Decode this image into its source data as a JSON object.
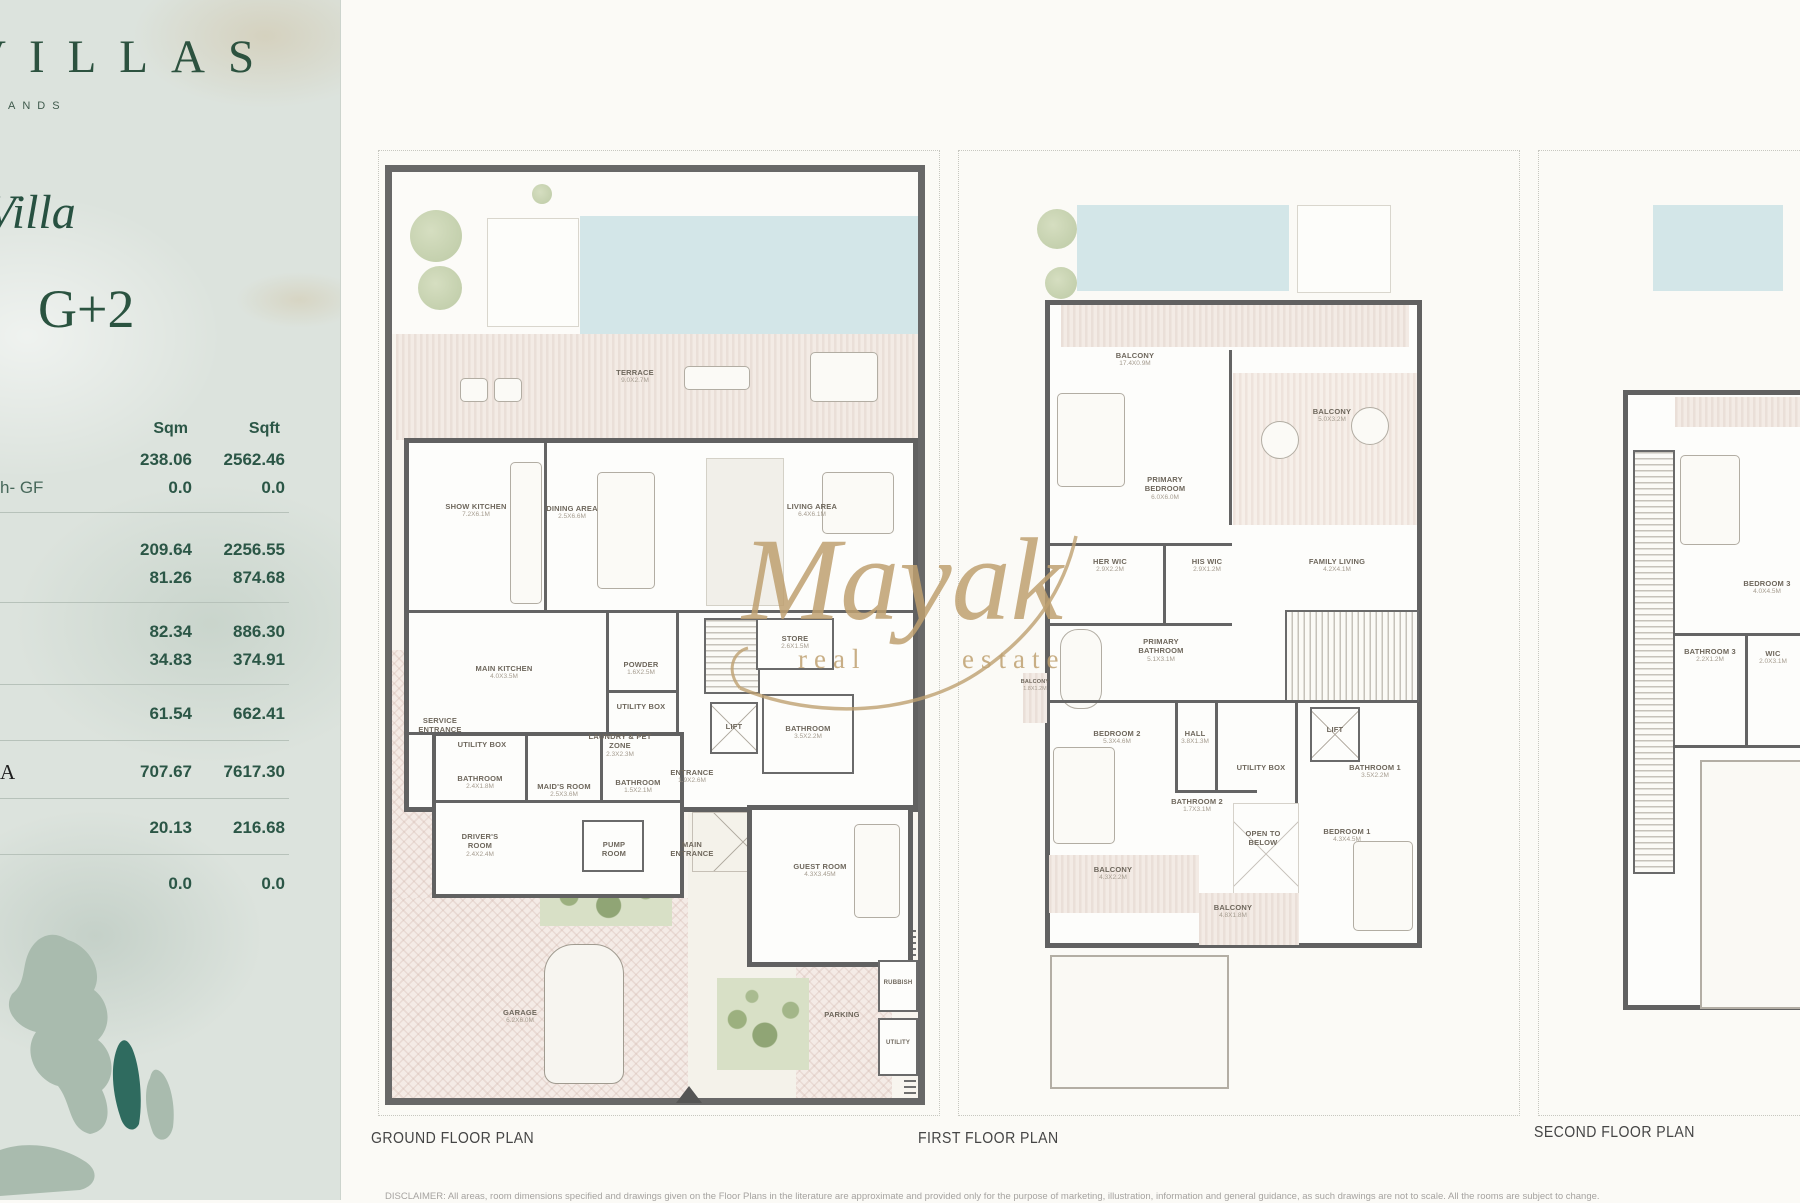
{
  "sidebar": {
    "logo_text": "VILLAS",
    "logo_sub": "ANDS",
    "villa_title": "Villa",
    "storeys": "G+2",
    "table": {
      "col1": "Sqm",
      "col2": "Sqft",
      "rows": [
        {
          "label": "",
          "sqm": "238.06",
          "sqft": "2562.46"
        },
        {
          "label": "h- GF",
          "sqm": "0.0",
          "sqft": "0.0"
        },
        {
          "label": "",
          "sqm": "209.64",
          "sqft": "2256.55"
        },
        {
          "label": "",
          "sqm": "81.26",
          "sqft": "874.68"
        },
        {
          "label": "",
          "sqm": "82.34",
          "sqft": "886.30"
        },
        {
          "label": "",
          "sqm": "34.83",
          "sqft": "374.91"
        },
        {
          "label": "",
          "sqm": "61.54",
          "sqft": "662.41"
        },
        {
          "label": "A",
          "sqm": "707.67",
          "sqft": "7617.30"
        },
        {
          "label": "",
          "sqm": "20.13",
          "sqft": "216.68"
        },
        {
          "label": "",
          "sqm": "0.0",
          "sqft": "0.0"
        }
      ]
    }
  },
  "watermark": {
    "script": "Mayak",
    "word1": "real",
    "word2": "estate"
  },
  "plans": {
    "ground": {
      "title": "GROUND FLOOR PLAN",
      "rooms": {
        "terrace": {
          "name": "TERRACE",
          "dim": "9.0X2.7M"
        },
        "show_kitchen": {
          "name": "SHOW KITCHEN",
          "dim": "7.2X6.1M"
        },
        "dining": {
          "name": "DINING AREA",
          "dim": "2.5X6.6M"
        },
        "living": {
          "name": "LIVING AREA",
          "dim": "6.4X6.1M"
        },
        "main_kitchen": {
          "name": "MAIN KITCHEN",
          "dim": "4.0X3.5M"
        },
        "powder": {
          "name": "POWDER",
          "dim": "1.6X2.5M"
        },
        "utility_box_1": {
          "name": "UTILITY BOX",
          "dim": ""
        },
        "store": {
          "name": "STORE",
          "dim": "2.6X1.5M"
        },
        "lift": {
          "name": "LIFT",
          "dim": ""
        },
        "bathroom_gf": {
          "name": "BATHROOM",
          "dim": "3.5X2.2M"
        },
        "entrance": {
          "name": "ENTRANCE",
          "dim": "1.9X2.6M"
        },
        "utility_box_2": {
          "name": "UTILITY BOX",
          "dim": ""
        },
        "laundry": {
          "name": "LAUNDRY & PET ZONE",
          "dim": "2.3X2.3M"
        },
        "service_entrance": {
          "name": "SERVICE ENTRANCE",
          "dim": ""
        },
        "bathroom_maid": {
          "name": "BATHROOM",
          "dim": "2.4X1.8M"
        },
        "maids_room": {
          "name": "MAID'S ROOM",
          "dim": "2.5X3.6M"
        },
        "bathroom_small": {
          "name": "BATHROOM",
          "dim": "1.5X2.1M"
        },
        "drivers_room": {
          "name": "DRIVER'S ROOM",
          "dim": "2.4X2.4M"
        },
        "pump_room": {
          "name": "PUMP ROOM",
          "dim": ""
        },
        "main_entrance": {
          "name": "MAIN ENTRANCE",
          "dim": ""
        },
        "guest_room": {
          "name": "GUEST ROOM",
          "dim": "4.3X3.45M"
        },
        "garage": {
          "name": "GARAGE",
          "dim": "6.2X6.0M"
        },
        "parking": {
          "name": "PARKING",
          "dim": ""
        },
        "rubbish": {
          "name": "RUBBISH",
          "dim": ""
        },
        "utility": {
          "name": "UTILITY",
          "dim": ""
        }
      }
    },
    "first": {
      "title": "FIRST FLOOR PLAN",
      "rooms": {
        "balcony_top": {
          "name": "BALCONY",
          "dim": "17.4X0.9M"
        },
        "primary_bedroom": {
          "name": "PRIMARY BEDROOM",
          "dim": "6.0X6.0M"
        },
        "balcony_right": {
          "name": "BALCONY",
          "dim": "5.0X3.2M"
        },
        "balcony_left": {
          "name": "BALCONY",
          "dim": "1.8X1.2M"
        },
        "her_wic": {
          "name": "HER WIC",
          "dim": "2.9X2.2M"
        },
        "his_wic": {
          "name": "HIS WIC",
          "dim": "2.9X1.2M"
        },
        "family_living": {
          "name": "FAMILY LIVING",
          "dim": "4.2X4.1M"
        },
        "primary_bathroom": {
          "name": "PRIMARY BATHROOM",
          "dim": "5.1X3.1M"
        },
        "bedroom_2": {
          "name": "BEDROOM 2",
          "dim": "5.3X4.6M"
        },
        "hall": {
          "name": "HALL",
          "dim": "3.8X1.3M"
        },
        "lift": {
          "name": "LIFT",
          "dim": ""
        },
        "bathroom_1": {
          "name": "BATHROOM 1",
          "dim": "3.5X2.2M"
        },
        "utility_box": {
          "name": "UTILITY BOX",
          "dim": ""
        },
        "bathroom_2": {
          "name": "BATHROOM 2",
          "dim": "1.7X3.1M"
        },
        "open_to_below": {
          "name": "OPEN TO BELOW",
          "dim": ""
        },
        "bedroom_1": {
          "name": "BEDROOM 1",
          "dim": "4.3X4.5M"
        },
        "balcony_bl": {
          "name": "BALCONY",
          "dim": "4.3X2.2M"
        },
        "balcony_bc": {
          "name": "BALCONY",
          "dim": "4.8X1.8M"
        }
      }
    },
    "second": {
      "title": "SECOND FLOOR PLAN",
      "rooms": {
        "bedroom_3": {
          "name": "BEDROOM 3",
          "dim": "4.0X4.5M"
        },
        "bathroom_3": {
          "name": "BATHROOM 3",
          "dim": "2.2X1.2M"
        },
        "wic": {
          "name": "WIC",
          "dim": "2.0X3.1M"
        }
      }
    }
  },
  "disclaimer": "DISCLAIMER: All areas, room dimensions specified and drawings given on the Floor Plans in the literature are approximate and provided only for the purpose of marketing, illustration, information and general guidance, as such drawings are not to scale. All the rooms are subject to change."
}
